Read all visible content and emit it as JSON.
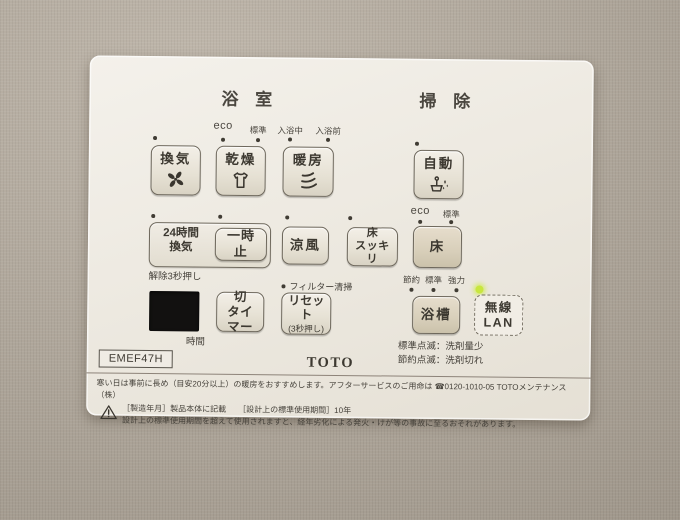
{
  "header": {
    "bath": "浴 室",
    "clean": "掃 除"
  },
  "row1": {
    "labels": {
      "eco": "eco",
      "std": "標準",
      "bathing": "入浴中",
      "prebath": "入浴前"
    },
    "buttons": {
      "vent": {
        "label": "換気",
        "icon": "fan-icon"
      },
      "dry": {
        "label": "乾燥",
        "icon": "shirt-icon"
      },
      "heat": {
        "label": "暖房",
        "icon": "heatwave-icon"
      },
      "auto": {
        "label": "自動",
        "icon": "autoclean-icon"
      }
    },
    "auto_sub": {
      "eco": "eco",
      "std": "標準"
    }
  },
  "row2": {
    "vent24": {
      "label": "24時間\n換気"
    },
    "pause": {
      "label": "一時止"
    },
    "cool": {
      "label": "涼風"
    },
    "floor_dry": {
      "label": "床\nスッキリ"
    },
    "floor": {
      "label": "床"
    },
    "release_note": "解除3秒押し",
    "power": {
      "save": "節約",
      "std": "標準",
      "strong": "強力"
    }
  },
  "row3": {
    "display_unit": "時間",
    "off_timer": {
      "label": "切\nタイマー"
    },
    "reset": {
      "label": "リセット",
      "sublabel": "(3秒押し)"
    },
    "filter_note": "フィルター清掃",
    "bathtub": {
      "label": "浴槽"
    },
    "wlan": {
      "label": "無線\nLAN"
    },
    "notes": {
      "std_blink": "標準点滅：洗剤量少",
      "save_blink": "節約点滅：洗剤切れ"
    }
  },
  "footer": {
    "model": "EMEF47H",
    "brand": "TOTO",
    "line1": "寒い日は事前に長め（目安20分以上）の暖房をおすすめします。アフターサービスのご用命は ☎0120-1010-05 TOTOメンテナンス（株）",
    "line2": "［製造年月］製品本体に記載　　［設計上の標準使用期間］10年",
    "line3": "設計上の標準使用期間を超えて使用されますと、経年劣化による発火・けが等の事故に至るおそれがあります。"
  },
  "colors": {
    "wall": "#b3a99b",
    "panel": "#ece8df",
    "button_face": "#e9e4d7",
    "led_on": "#c8e63e",
    "text": "#45413a"
  }
}
